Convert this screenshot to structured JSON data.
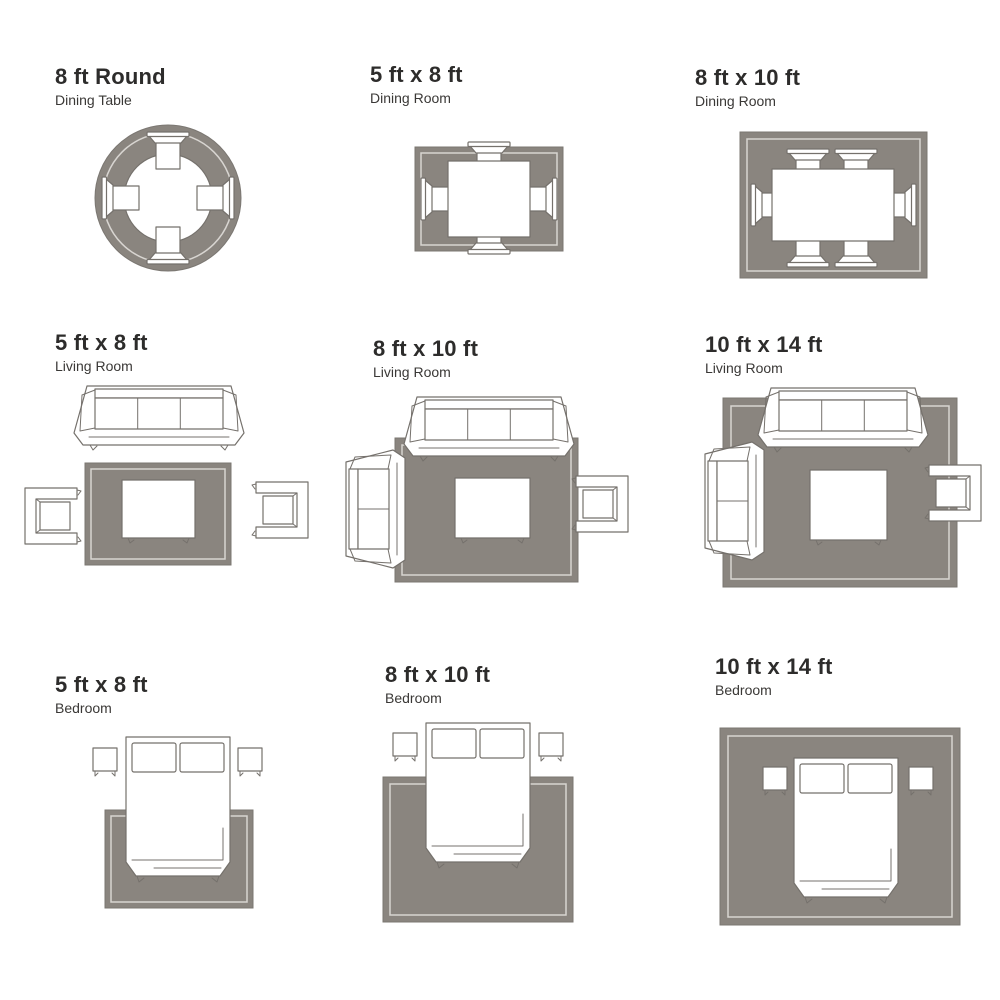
{
  "colors": {
    "background": "#ffffff",
    "rug": "#8a857f",
    "rug_border_line": "#d8d5d1",
    "furniture_line": "#75716c",
    "text": "#2d2c2b"
  },
  "panels": [
    {
      "title": "8 ft Round",
      "subtitle": "Dining Table",
      "furniture": [
        "round-rug",
        "round-dining-table",
        "dining-chair x4"
      ]
    },
    {
      "title": "5 ft x 8 ft",
      "subtitle": "Dining Room",
      "furniture": [
        "rug",
        "dining-table",
        "dining-chair x4"
      ]
    },
    {
      "title": "8 ft x 10 ft",
      "subtitle": "Dining Room",
      "furniture": [
        "rug",
        "dining-table",
        "dining-chair x6"
      ]
    },
    {
      "title": "5 ft x 8 ft",
      "subtitle": "Living Room",
      "furniture": [
        "sofa",
        "rug",
        "coffee-table",
        "armchair x2"
      ]
    },
    {
      "title": "8 ft x 10 ft",
      "subtitle": "Living Room",
      "furniture": [
        "rug",
        "sofa",
        "loveseat",
        "armchair",
        "coffee-table"
      ]
    },
    {
      "title": "10 ft x 14 ft",
      "subtitle": "Living Room",
      "furniture": [
        "rug",
        "sofa",
        "loveseat",
        "armchair",
        "coffee-table"
      ]
    },
    {
      "title": "5 ft x 8 ft",
      "subtitle": "Bedroom",
      "furniture": [
        "rug",
        "bed",
        "nightstand x2"
      ]
    },
    {
      "title": "8 ft x 10 ft",
      "subtitle": "Bedroom",
      "furniture": [
        "rug",
        "bed",
        "nightstand x2"
      ]
    },
    {
      "title": "10 ft x 14 ft",
      "subtitle": "Bedroom",
      "furniture": [
        "rug",
        "bed",
        "nightstand x2"
      ]
    }
  ]
}
